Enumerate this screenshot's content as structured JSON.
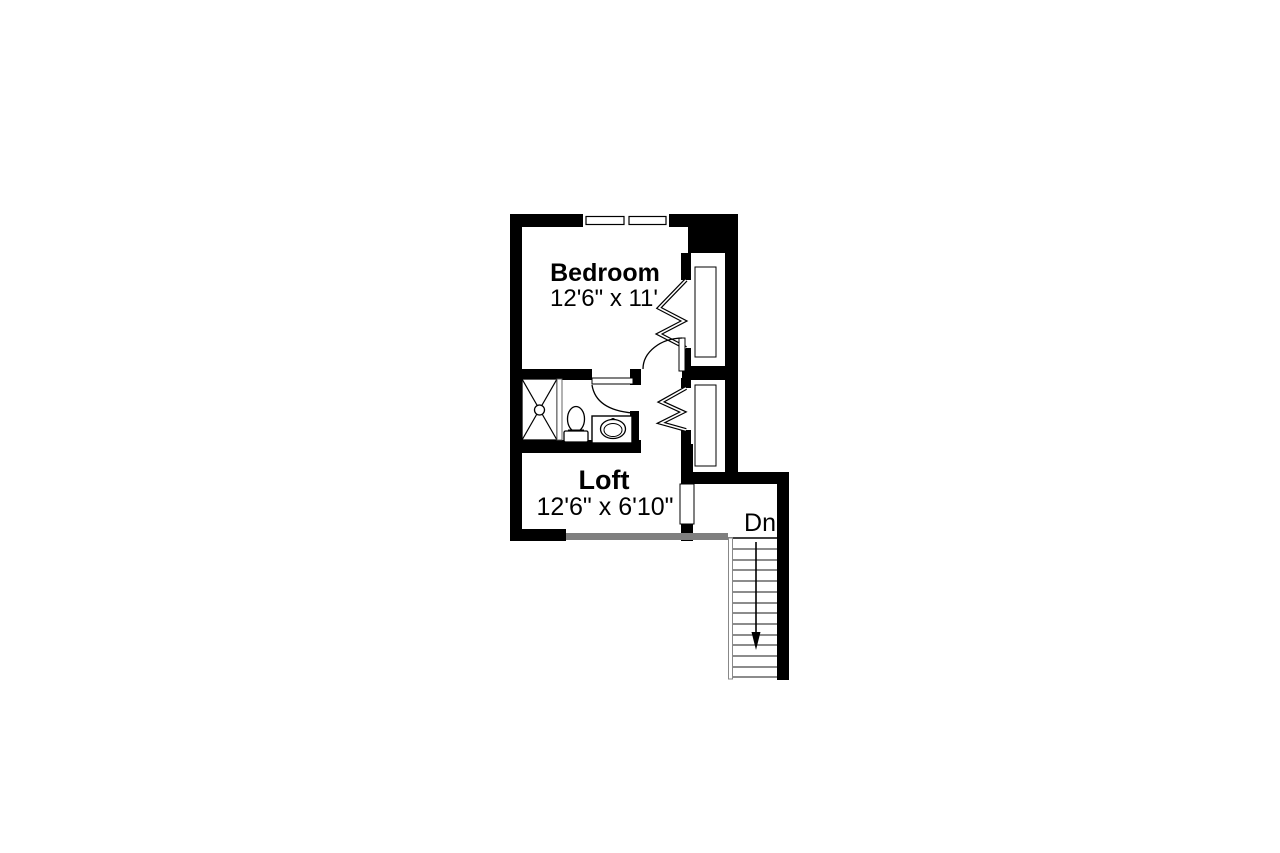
{
  "plan": {
    "type": "floor-plan",
    "title": "upper floor plan",
    "colors": {
      "walls": "#000000",
      "railing": "#7f7f7f",
      "background": "#ffffff",
      "text": "#000000"
    },
    "rooms": {
      "bedroom": {
        "name": "Bedroom",
        "dimensions": "12'6\" x 11'"
      },
      "loft": {
        "name": "Loft",
        "dimensions": "12'6\" x 6'10\""
      }
    },
    "stairs": {
      "label": "Dn",
      "direction": "down",
      "tread_count": 13
    },
    "fixtures": [
      "shower",
      "toilet",
      "sink-vanity"
    ],
    "features": [
      "window",
      "bedroom-closet-bifold",
      "hall-closet-bifold",
      "stair-railing",
      "cased-opening"
    ]
  }
}
